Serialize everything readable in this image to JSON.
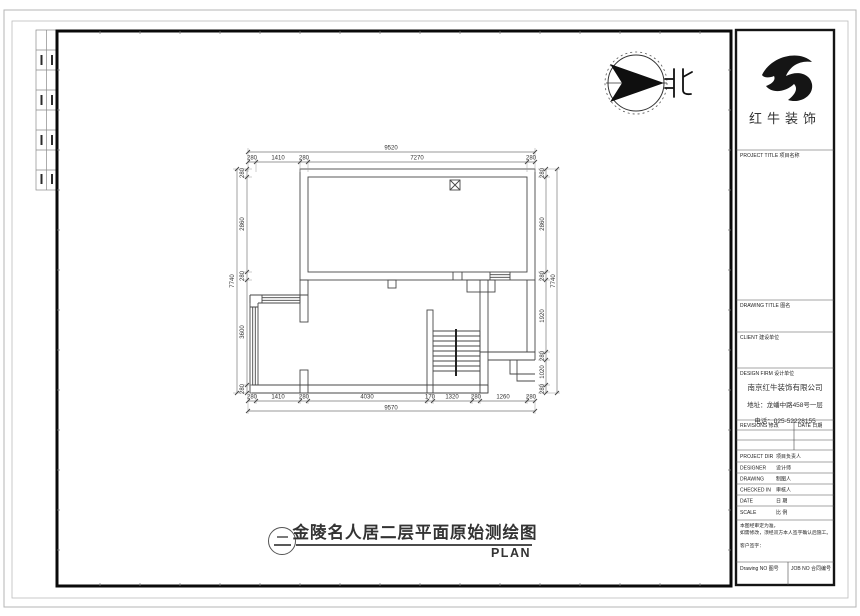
{
  "compass": {
    "label": "北"
  },
  "drawing": {
    "index_symbol": "二",
    "title": "金陵名人居二层平面原始测绘图",
    "subtitle": "PLAN"
  },
  "dimensions": {
    "top": {
      "total": "9520",
      "segments": [
        "280",
        "1410",
        "280",
        "7270",
        "280"
      ]
    },
    "bottom": {
      "total": "9570",
      "segments": [
        "280",
        "1410",
        "280",
        "4030",
        "170",
        "1320",
        "280",
        "1260",
        "280"
      ]
    },
    "left": {
      "total": "7740",
      "segments": [
        "280",
        "2860",
        "280",
        "3600",
        "280"
      ]
    },
    "right": {
      "total": "7740",
      "segments": [
        "280",
        "2860",
        "280",
        "1920",
        "280",
        "1020",
        "280"
      ]
    }
  },
  "title_block": {
    "brand": "红牛装饰",
    "project_title_header": "PROJECT TITLE 项目名称",
    "drawing_title_header": "DRAWING TITLE 图名",
    "client_header": "CLIENT 建设单位",
    "firm_header": "DESIGN FIRM 设计单位",
    "company_name": "南京红牛装饰有限公司",
    "company_address": "地址：龙蟠中路458号一层",
    "company_phone": "电话：025-52228155",
    "revisions_header": "REVISIONS 修改",
    "date_header": "DATE 日期",
    "fields": [
      {
        "en": "PROJECT DIR",
        "cn": "项目负责人"
      },
      {
        "en": "DESIGNER",
        "cn": "设计师"
      },
      {
        "en": "DRAWING",
        "cn": "制图人"
      },
      {
        "en": "CHECKED IN",
        "cn": "审核人"
      },
      {
        "en": "DATE",
        "cn": "日 期"
      },
      {
        "en": "SCALE",
        "cn": "比 例"
      }
    ],
    "note_line1": "本图经审定为准，",
    "note_line2": "如需修改，须经双方本人签字确认后施工。",
    "note_line3": "客户签字：",
    "drawing_no_label": "Drawing NO 图号",
    "job_no_label": "JOB NO 合同编号"
  }
}
